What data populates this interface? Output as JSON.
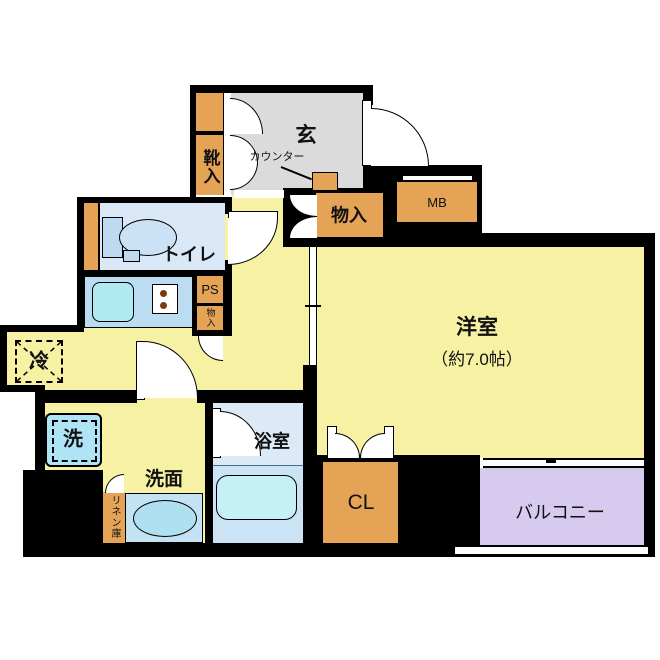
{
  "floorplan": {
    "labels": {
      "genkan": "玄",
      "shoe_cabinet": "靴入",
      "counter": "カウンター",
      "hall_closet": "物入",
      "meter_box": "MB",
      "toilet": "トイレ",
      "pipe_space": "PS",
      "small_closet": "物入",
      "refrigerator": "冷",
      "western_room": "洋室",
      "western_room_size": "（約7.0帖）",
      "washer": "洗",
      "washroom": "洗面",
      "linen_closet": "リネン庫",
      "bathroom": "浴室",
      "closet": "CL",
      "balcony": "バルコニー"
    },
    "colors": {
      "wall": "#000000",
      "room_yellow": "#F6F1A3",
      "genkan_gray": "#DBDBDB",
      "storage_orange": "#E5A356",
      "water_room_blue": "#D9E7F7",
      "kitchen_counter_blue": "#BCDCF2",
      "fixture_cyan": "#B9ECF2",
      "balcony_purple": "#D7CAEF"
    }
  }
}
